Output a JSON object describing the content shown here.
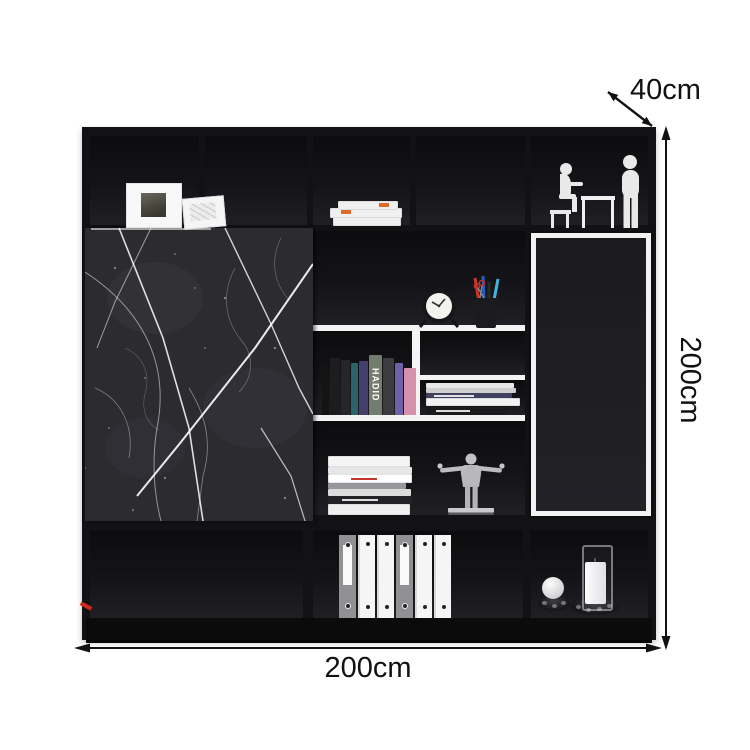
{
  "dimensions": {
    "depth_label": "40cm",
    "height_label": "200cm",
    "width_label": "200cm"
  },
  "cabinet": {
    "book_spine_label": "HADID",
    "colors": {
      "frame_black": "#121214",
      "shelf_white": "#f4f4f4",
      "marble_base": "#2b2b30",
      "marble_vein": "#ffffff",
      "door_panel": "#1c1c20",
      "accent_red": "#d0281c",
      "binder_grey": "#919194",
      "book_pink": "#d690ab",
      "book_purple": "#6e61a8",
      "book_teal": "#2a6468",
      "pen_red": "#cc3327",
      "pen_blue": "#1f5fc2",
      "pen_cyan": "#3fb6dc",
      "figurine_white": "#e9e9e9",
      "figurine_silver": "#b8b8bb"
    }
  }
}
